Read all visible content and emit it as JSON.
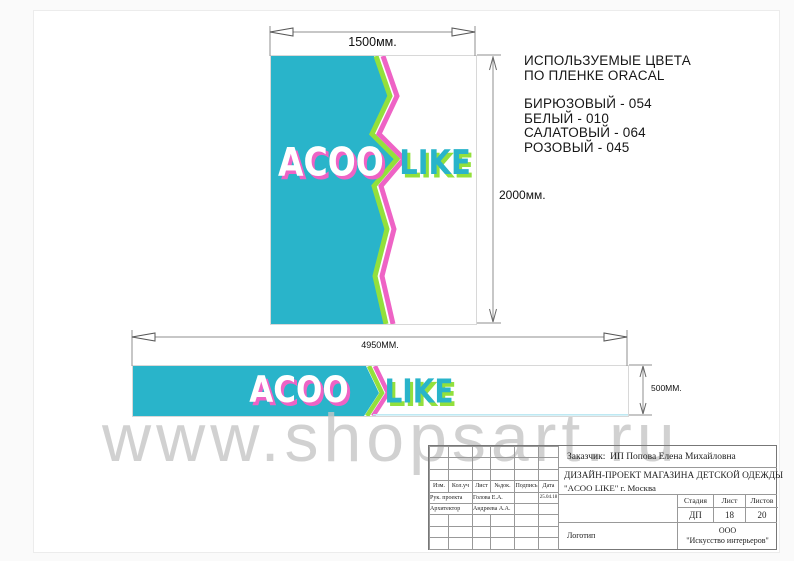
{
  "logo": {
    "word1": "ACOO",
    "word2": "LIKE"
  },
  "colors_note": {
    "title_line1": "ИСПОЛЬЗУЕМЫЕ ЦВЕТА",
    "title_line2": "ПО ПЛЕНКЕ ORACAL",
    "items": [
      "БИРЮЗОВЫЙ - 054",
      "БЕЛЫЙ - 010",
      "САЛАТОВЫЙ - 064",
      "РОЗОВЫЙ - 045"
    ]
  },
  "dimensions": {
    "vertical_banner_width": "1500мм.",
    "vertical_banner_height": "2000мм.",
    "horizontal_banner_width": "4950ММ.",
    "horizontal_banner_height": "500ММ."
  },
  "watermark": "www.shopsart.ru",
  "title_block": {
    "customer_label": "Заказчик:",
    "customer": "ИП Попова Елена Михайловна",
    "project_line1": "ДИЗАЙН-ПРОЕКТ МАГАЗИНА ДЕТСКОЙ ОДЕЖДЫ",
    "project_line2": "\"ACOO LIKE\"  г. Москва",
    "columns": [
      "Изм.",
      "Кол.уч",
      "Лист",
      "№док.",
      "Подпись",
      "Дата"
    ],
    "rows": [
      {
        "role": "Рук. проекта",
        "name": "Голова Е.А.",
        "date": "25.04.18"
      },
      {
        "role": "Архитектор",
        "name": "Андреева А.А.",
        "date": ""
      }
    ],
    "stage_label": "Стадия",
    "sheet_label": "Лист",
    "sheets_label": "Листов",
    "stage": "ДП",
    "sheet": "18",
    "sheets": "20",
    "logo_cell": "Логотип",
    "company_line1": "ООО",
    "company_line2": "\"Искусство интерьеров\""
  },
  "palette": {
    "turquoise": "#29b4ca",
    "pink": "#ee63c5",
    "green": "#93e03c",
    "white": "#ffffff"
  }
}
